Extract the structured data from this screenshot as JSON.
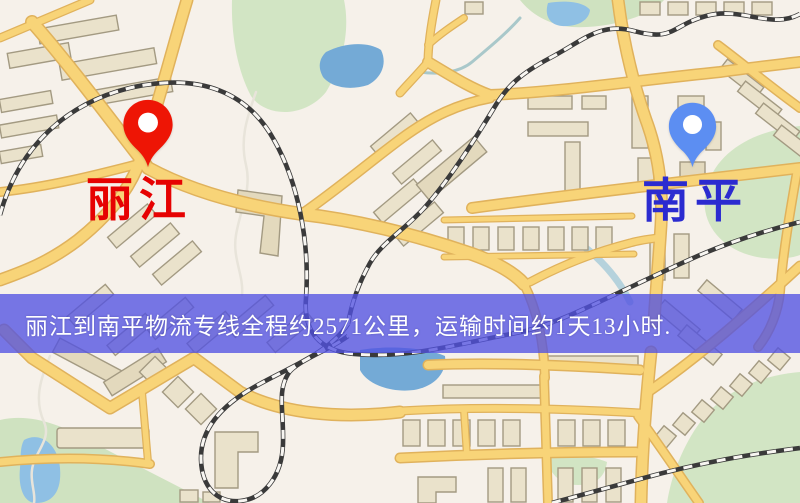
{
  "banner": {
    "text": "丽江到南平物流专线全程约2571公里，运输时间约1天13小时.",
    "bg_style": "background:rgba(82,82,226,0.78)",
    "bg_color": "#5252e2",
    "text_color": "#ffffff",
    "distance_km": "2571",
    "duration": "1天13小时"
  },
  "markers": {
    "origin": {
      "label": "丽江",
      "label_style": "color:#e60202",
      "label_color": "#e60202",
      "pin_color": "#ee1505",
      "icon": "location-pin-icon"
    },
    "destination": {
      "label": "南平",
      "label_style": "color:#2b2bd0",
      "label_color": "#2b2bd0",
      "pin_color": "#5c8ef2",
      "icon": "location-pin-icon"
    }
  },
  "map": {
    "colors": {
      "background": "#f6f1ea",
      "road_fill": "#f8d478",
      "road_casing": "#e0b25c",
      "building": "#eae2cb",
      "park": "#d2e5c4",
      "water": "#74aad6",
      "railway": "#3a3a3a"
    }
  }
}
